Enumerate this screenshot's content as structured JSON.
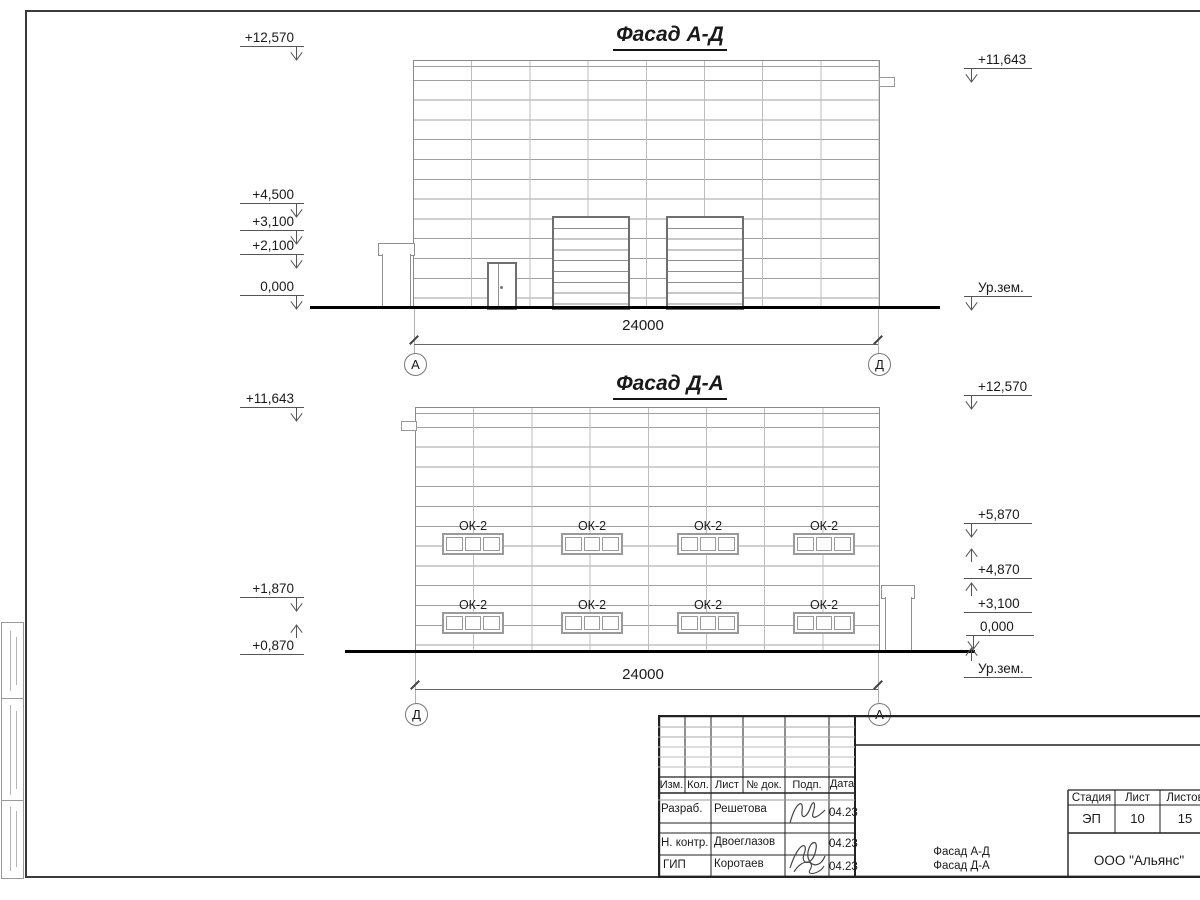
{
  "facade_top": {
    "title": "Фасад А-Д",
    "dimension": "24000",
    "axis_left": "А",
    "axis_right": "Д",
    "levels_left": [
      "+12,570",
      "+4,500",
      "+3,100",
      "+2,100",
      "0,000"
    ],
    "levels_right": [
      "+11,643",
      "Ур.зем."
    ]
  },
  "facade_bottom": {
    "title": "Фасад Д-А",
    "dimension": "24000",
    "axis_left": "Д",
    "axis_right": "А",
    "levels_left": [
      "+11,643",
      "+1,870",
      "+0,870"
    ],
    "levels_right": [
      "+12,570",
      "+5,870",
      "+4,870",
      "+3,100",
      "0,000",
      "Ур.зем."
    ],
    "window_label": "ОК-2"
  },
  "title_block": {
    "columns": [
      "Изм.",
      "Кол.",
      "Лист",
      "№ док.",
      "Подп.",
      "Дата"
    ],
    "rows": [
      {
        "role": "Разраб.",
        "name": "Решетова",
        "date": "04.23"
      },
      {
        "role": "Н. контр.",
        "name": "Двоеглазов",
        "date": "04.23"
      },
      {
        "role": "ГИП",
        "name": "Коротаев",
        "date": "04.23"
      }
    ],
    "doc_name_line1": "Фасад А-Д",
    "doc_name_line2": "Фасад Д-А",
    "stage_label": "Стадия",
    "sheet_label": "Лист",
    "sheets_label": "Листов",
    "stage_value": "ЭП",
    "sheet_value": "10",
    "sheets_value": "15",
    "company": "ООО \"Альянс\""
  }
}
